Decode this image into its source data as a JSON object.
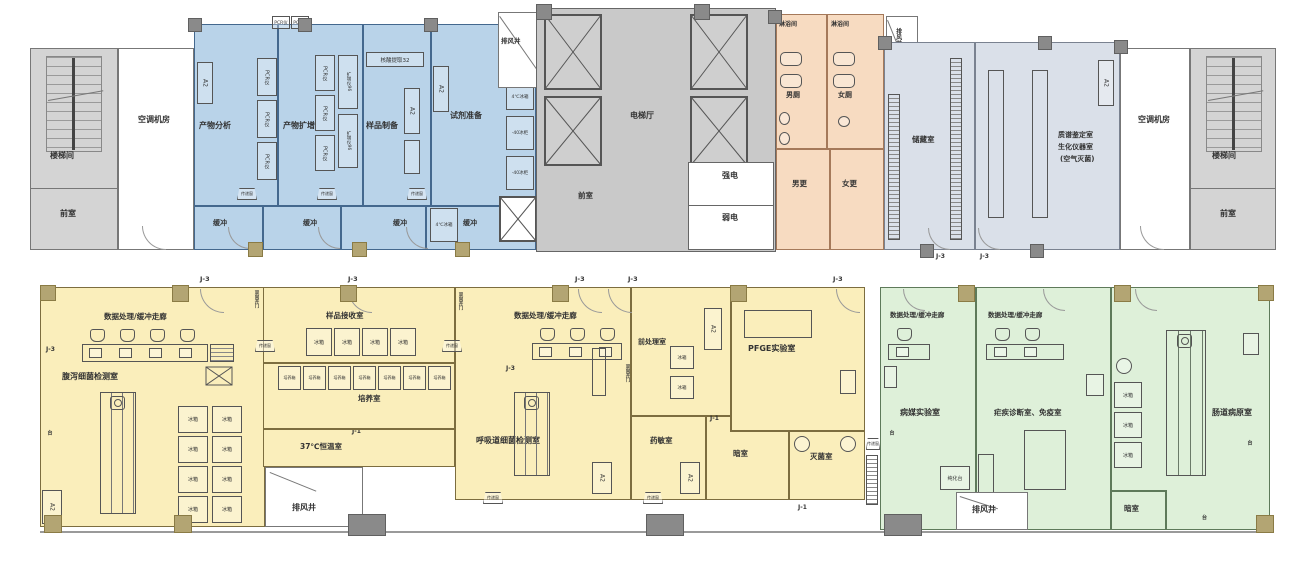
{
  "labels": {
    "stairwell": "楼梯间",
    "anteroom": "前室",
    "ac_room": "空调机房",
    "product_analysis": "产物分析",
    "product_amplification": "产物扩增",
    "sample_prep": "样品制备",
    "reagent_prep": "试剂准备",
    "buffer": "缓冲",
    "pcr_unit": "PCR仪",
    "amplifier_96": "扩增仪96",
    "nucleic_extract_32": "核酸提取32",
    "fridge_4c": "4℃冰箱",
    "freezer_m40": "-40冰柜",
    "fridge": "冰箱",
    "incubator_box": "培养箱",
    "exhaust_shaft": "排风井",
    "elevator_hall": "电梯厅",
    "strong_power": "强电",
    "weak_power": "弱电",
    "shower_room": "淋浴间",
    "male_toilet": "男厕",
    "female_toilet": "女厕",
    "male_changing": "男更",
    "female_changing": "女更",
    "storage_room": "储藏室",
    "ms_line1": "质谱鉴定室",
    "ms_line2": "生化仪器室",
    "ms_line3": "(空气灭菌)",
    "door_j3": "J-3",
    "door_j1": "J-1",
    "bsc_a2": "A2",
    "data_buffer_corridor": "数据处理/缓冲走廊",
    "diarrhea_lab": "腹泻细菌检测室",
    "sample_receiving": "样品接收室",
    "culture_room": "培养室",
    "incubation_37": "37℃恒温室",
    "respiratory_lab": "呼吸道细菌检测室",
    "pretreatment": "前处理室",
    "pfge_lab": "PFGE实验室",
    "drug_sensitivity": "药敏室",
    "dark_room": "暗室",
    "sterilization_room": "灭菌室",
    "vector_lab": "病媒实验室",
    "malaria_immune": "疟疾诊断室、免疫室",
    "enteric_pathogen": "肠道病原室",
    "purify_bench": "纯化台",
    "pass_window": "传递窗",
    "double_swing_door": "双向开门",
    "bench_tag": "台"
  },
  "colors": {
    "pcr_zone_blue": "#b9d3e9",
    "sanitary_zone_orange": "#f7dbc1",
    "instrument_zone_grey": "#dae0e9",
    "bacteriology_zone_yellow": "#faeebb",
    "parasitology_zone_green": "#def0d9",
    "core_grey": "#c9c9c9",
    "wall": "#666666",
    "column_dark": "#8a8a8a",
    "column_khaki": "#b3a573"
  }
}
